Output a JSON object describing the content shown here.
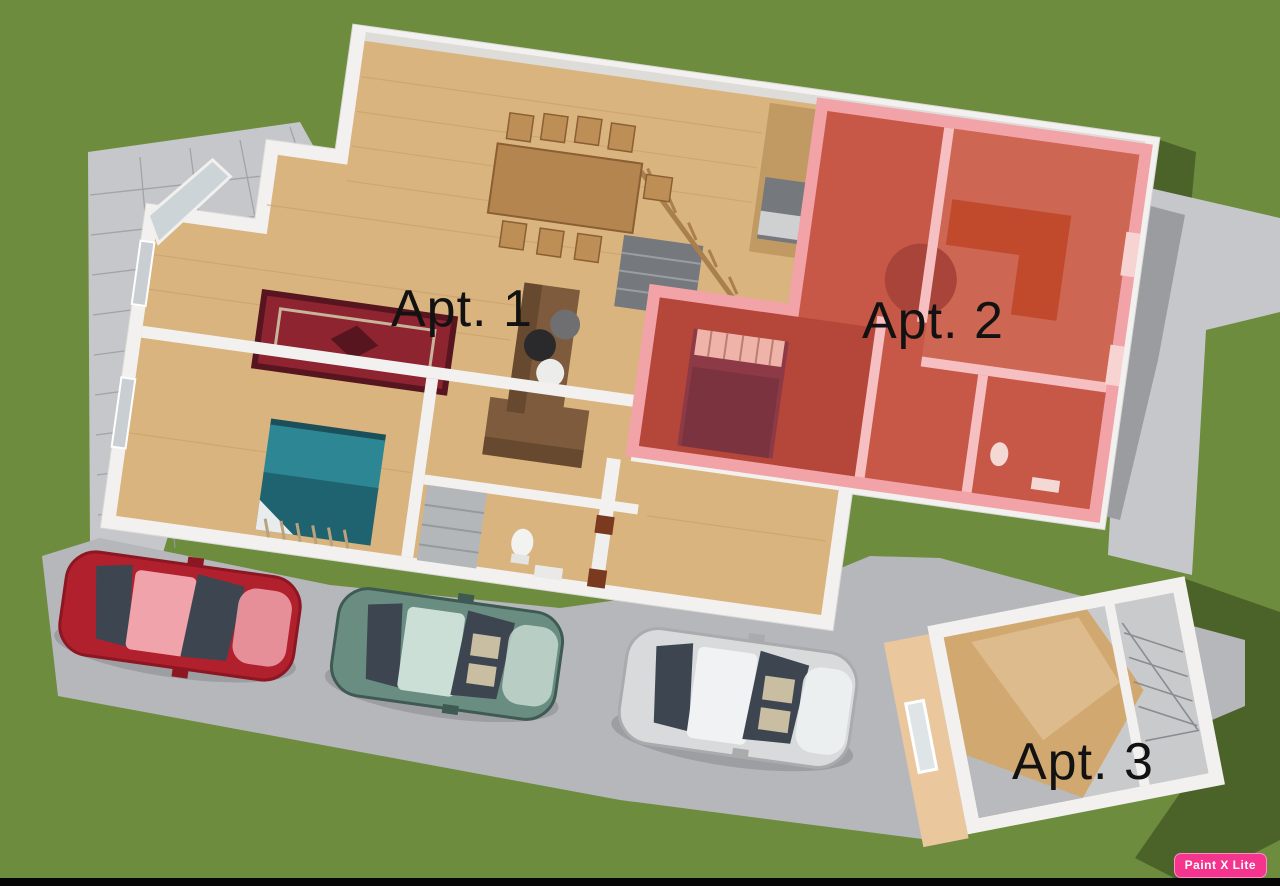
{
  "apartments": [
    {
      "id": "apt-1",
      "label": "Apt. 1"
    },
    {
      "id": "apt-2",
      "label": "Apt. 2"
    },
    {
      "id": "apt-3",
      "label": "Apt. 3"
    }
  ],
  "watermark": {
    "text": "Paint X Lite",
    "background": "#F5348E",
    "text_color": "#FFFFFF"
  },
  "colors": {
    "grass": "#6D8C3E",
    "grass_shadow": "#4B6329",
    "paving": "#B6B7BB",
    "paving_light": "#C6C7CA",
    "paving_shadow": "#9B9CA0",
    "tile_line": "#9A9B9F",
    "wall": "#F2F1EF",
    "wall_shade": "#D9D8D5",
    "wood": "#D9B47F",
    "wood_dark": "#C09A62",
    "wood_light": "#E7D0A5",
    "plank_line": "#C8A068",
    "gray_floor": "#75787C",
    "cabinet_gray": "#B4B7BA",
    "rug": "#8E2430",
    "rug_border": "#571520",
    "rug_accent": "#C8B49A",
    "table_wood": "#B5854F",
    "chair_wood": "#BD8E55",
    "sofa": "#7D5B3C",
    "sofa_dark": "#5E422A",
    "bed_teal": "#2D8694",
    "bed_teal_dark": "#1F6370",
    "window_glass": "#C9CED2",
    "apt2_overlay": "#F2A3A8",
    "apt2_wall": "#F6BFC1",
    "apt2_floor": "#C75847",
    "apt2_floor_light": "#CD6652",
    "apt2_floor_dark": "#B5463A",
    "apt2_stair": "#A8443A",
    "apt2_bed": "#8E3A46",
    "apt2_blanket": "#7C3340",
    "apt2_pillow": "#F0B3AA",
    "apt2_sofa": "#C24A2C",
    "apt2_fixture": "#F4D8D4",
    "apt3_tan": "#EAC79C",
    "apt3_wood": "#D2A871",
    "apt3_wood_light": "#E2C296",
    "apt3_gray": "#C9CACC",
    "stair_sketch": "#8A8D90",
    "car_red": "#B1202D",
    "car_red_light": "#F0A3AB",
    "car_teal": "#6A8D82",
    "car_teal_light": "#CCDFD6",
    "car_silver": "#D8DADC",
    "car_silver_light": "#F0F2F3",
    "car_window": "#3D4650",
    "car_seat": "#D8CBAA",
    "car_shadow": "#7E8084",
    "toilet_white": "#F2F2F0",
    "door_brown": "#7A3A20",
    "label_color": "#121212",
    "bottom_bar": "#060606"
  }
}
